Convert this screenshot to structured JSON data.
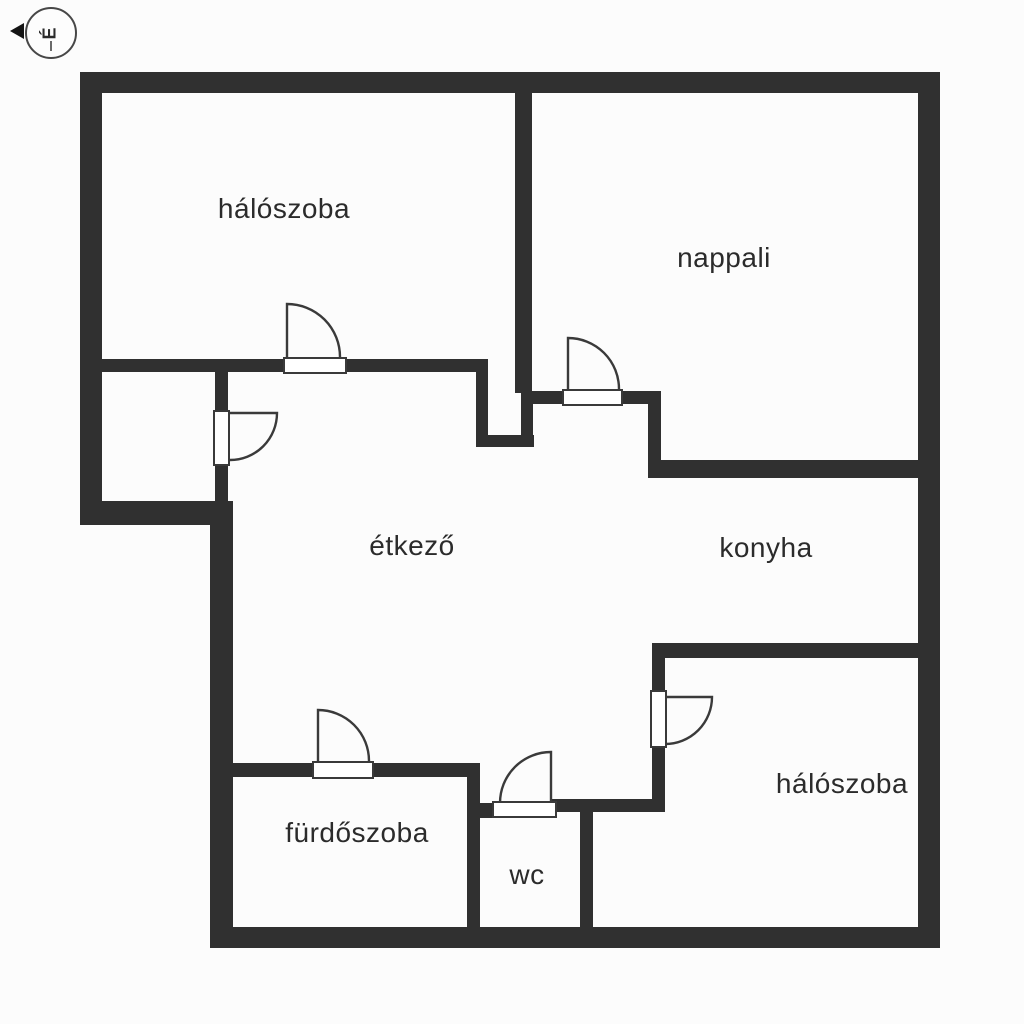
{
  "compass": {
    "letter": "É",
    "direction": "left"
  },
  "colors": {
    "wall": "#303030",
    "background": "#fcfcfc",
    "text": "#2b2b2b"
  },
  "rooms": [
    {
      "id": "haloszoba-1",
      "label": "hálószoba"
    },
    {
      "id": "nappali",
      "label": "nappali"
    },
    {
      "id": "etkezo",
      "label": "étkező"
    },
    {
      "id": "konyha",
      "label": "konyha"
    },
    {
      "id": "furdoszoba",
      "label": "fürdőszoba"
    },
    {
      "id": "wc",
      "label": "wc"
    },
    {
      "id": "haloszoba-2",
      "label": "hálószoba"
    }
  ]
}
